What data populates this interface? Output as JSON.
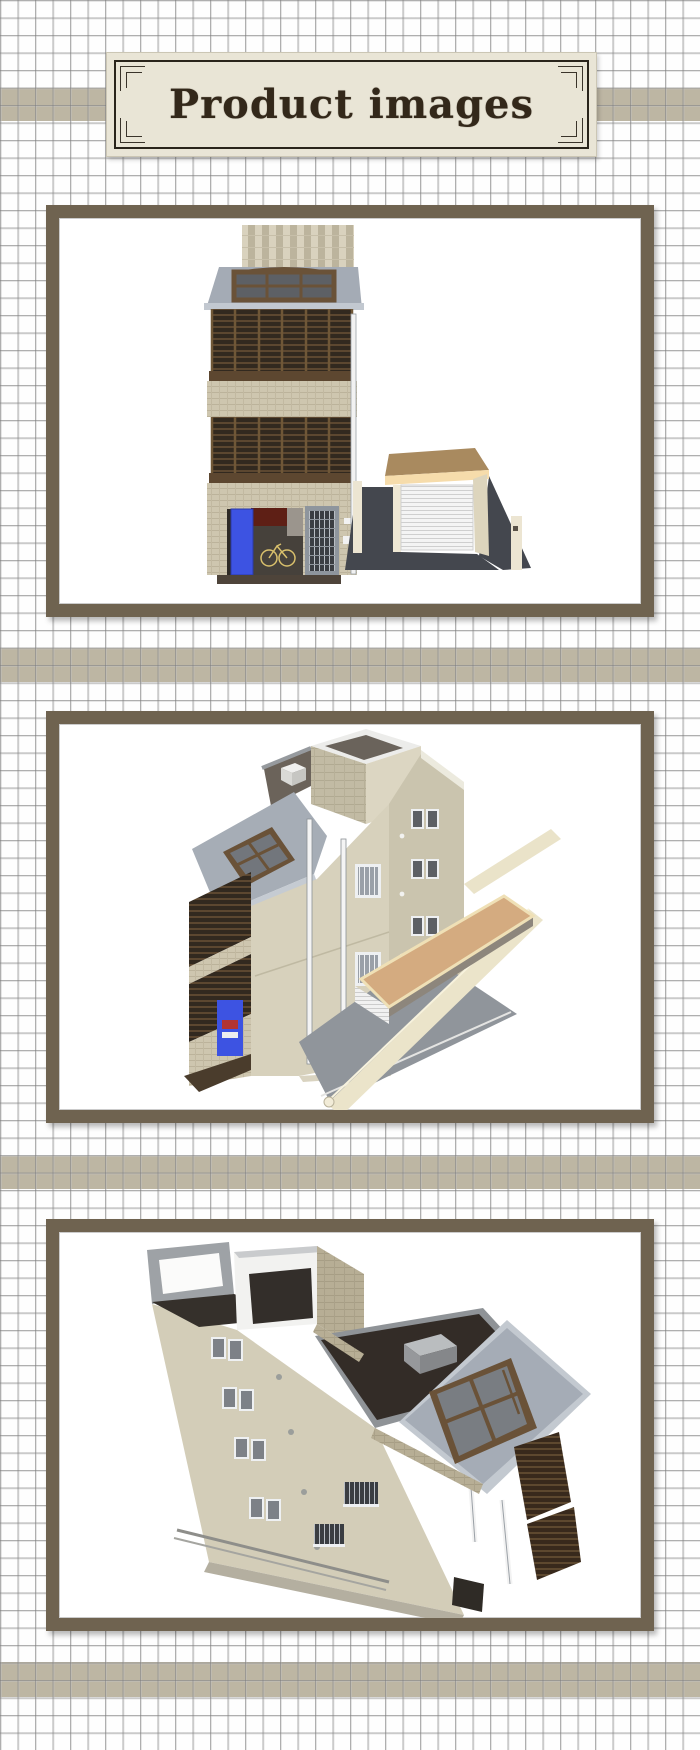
{
  "header": {
    "title": "Product images"
  },
  "gallery": {
    "images": [
      {
        "id": 1,
        "label": "3D rendering - front elevation of three-story house with louvered balconies, blue entry door and attached garage"
      },
      {
        "id": 2,
        "label": "3D rendering - perspective view from front-left showing rooftop bulkhead, carport, fence walls and driveway"
      },
      {
        "id": 3,
        "label": "3D rendering - aerial view from the rear showing rooftop terrace, dark roof deck and sloped skylight roof"
      }
    ]
  },
  "theme": {
    "band_color": "#bdb6a3",
    "frame_color": "#6f6350",
    "grid_line_color": "#787878",
    "title_bg": "#e9e5d6",
    "title_text_color": "#33281a",
    "blue_door": "#3d53e2",
    "carport_tan": "#d4ab80",
    "roof_gray": "#a5acb6",
    "louver_brown": "#32291f",
    "wall_cream": "#d3cdb8",
    "driveway_dark": "#44474e",
    "driveway_light": "#90959b"
  }
}
